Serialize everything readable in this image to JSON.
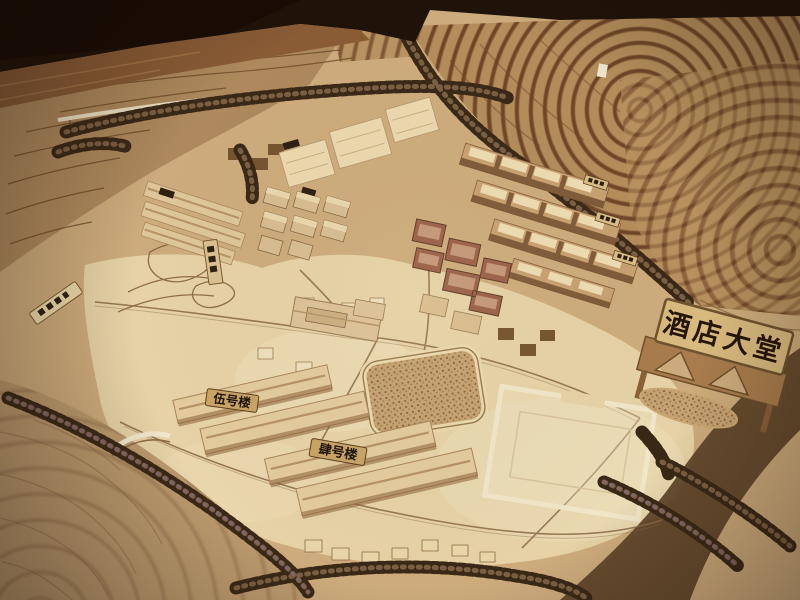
{
  "scene": {
    "colors": {
      "backdrop_dark": "#1f1208",
      "wood_floor": "#8a5c36",
      "terrain_tan": "#cdab7c",
      "terrace_dark": "#6e4627",
      "plaza_light": "#e6d2a6",
      "building_tan": "#e3cb9e",
      "building_red": "#9a6148",
      "tree_dark": "#3c2a19",
      "sign_plaque": "#d8b97e",
      "sign_text": "#241507"
    }
  },
  "signs": {
    "hotel_lobby": "酒店大堂",
    "building_no5": "伍号楼",
    "building_no4": "肆号楼"
  }
}
